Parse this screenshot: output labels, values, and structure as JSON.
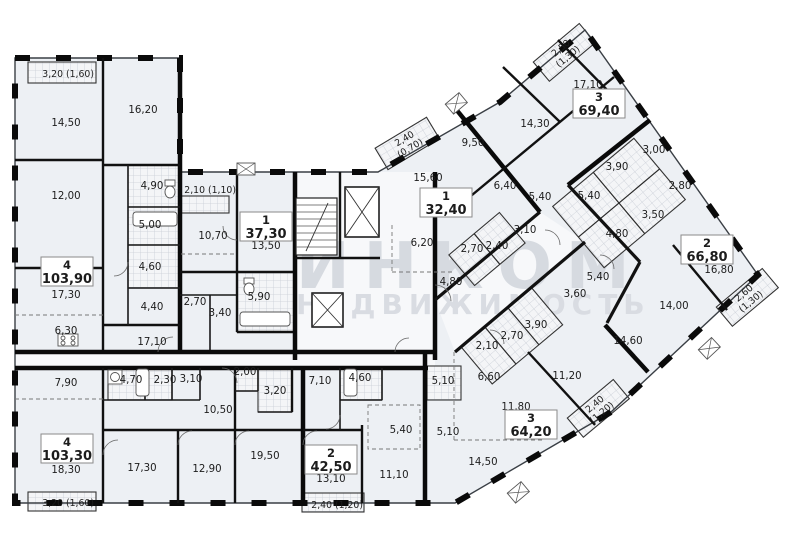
{
  "plan": {
    "watermark": {
      "brand": "ИНКОМ",
      "tagline": "НЕДВИЖИМОСТЬ"
    },
    "apartments": [
      {
        "rooms_label": "4",
        "total_area": "103,90",
        "rooms": [
          "14,50",
          "16,20",
          "12,00",
          "4,90",
          "5,00",
          "4,60",
          "4,40",
          "17,30",
          "6,30",
          "17,10"
        ],
        "balcony": {
          "size": "3,20",
          "reduced": "(1,60)"
        }
      },
      {
        "rooms_label": "1",
        "total_area": "37,30",
        "rooms": [
          "10,70",
          "13,50",
          "5,90",
          "2,70",
          "3,40"
        ],
        "balcony": {
          "size": "2,10",
          "reduced": "(1,10)"
        }
      },
      {
        "rooms_label": "1",
        "total_area": "32,40",
        "rooms": [
          "15,60",
          "6,20",
          "2,70",
          "2,40",
          "4,80"
        ],
        "balcony": {
          "size": "2,40",
          "reduced": "(0,70)"
        }
      },
      {
        "rooms_label": "3",
        "total_area": "69,40",
        "rooms": [
          "17,10",
          "14,30",
          "9,50",
          "6,40",
          "5,40",
          "3,10",
          "3,90",
          "5,40",
          "3,00"
        ],
        "balcony": {
          "size": "2,50",
          "reduced": "(1,30)"
        }
      },
      {
        "rooms_label": "2",
        "total_area": "66,80",
        "rooms": [
          "16,80",
          "14,00",
          "2,80",
          "3,50",
          "4,80",
          "14,60"
        ],
        "balcony": {
          "size": "2,60",
          "reduced": "(1,30)"
        }
      },
      {
        "rooms_label": "3",
        "total_area": "64,20",
        "rooms": [
          "11,80",
          "14,50",
          "11,20",
          "6,60",
          "2,10",
          "2,70",
          "3,90",
          "3,60",
          "5,40",
          "5,10"
        ],
        "balcony": {
          "size": "2,40",
          "reduced": "(1,20)"
        }
      },
      {
        "rooms_label": "2",
        "total_area": "42,50",
        "rooms": [
          "13,10",
          "11,10",
          "7,10",
          "4,60",
          "5,40",
          "5,10"
        ],
        "balcony": {
          "size": "2,40",
          "reduced": "(1,20)"
        }
      },
      {
        "rooms_label": "4",
        "total_area": "103,30",
        "rooms": [
          "18,30",
          "17,30",
          "12,90",
          "19,50",
          "10,50",
          "7,90",
          "4,70",
          "2,30",
          "3,10",
          "2,00",
          "3,20"
        ],
        "balcony": {
          "size": "3,20",
          "reduced": "(1,60)"
        }
      }
    ]
  }
}
